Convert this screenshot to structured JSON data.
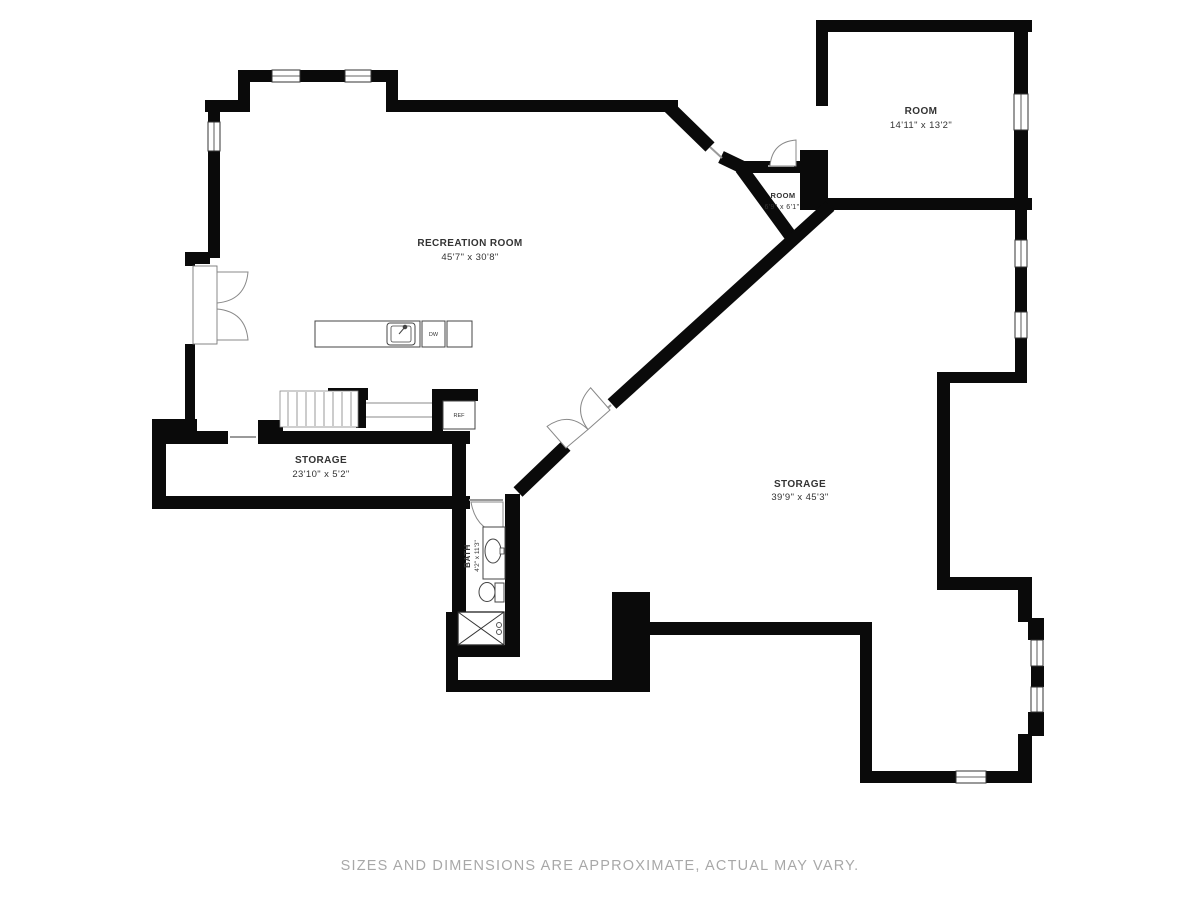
{
  "rooms": {
    "recreation_room": {
      "label": "RECREATION ROOM",
      "dimensions": "45'7\" x 30'8\""
    },
    "room_upper_right": {
      "label": "ROOM",
      "dimensions": "14'11\" x 13'2\""
    },
    "room_small": {
      "label": "ROOM",
      "dimensions": "6'9\" x 6'1\""
    },
    "storage_lower_left": {
      "label": "STORAGE",
      "dimensions": "23'10\" x 5'2\""
    },
    "storage_right": {
      "label": "STORAGE",
      "dimensions": "39'9\" x 45'3\""
    },
    "bath": {
      "label": "BATH",
      "dimensions": "4'2\" x 11'3\""
    }
  },
  "appliances": {
    "refrigerator_label": "REF",
    "dishwasher_label": "DW"
  },
  "footer": {
    "disclaimer": "SIZES AND DIMENSIONS ARE APPROXIMATE, ACTUAL MAY VARY."
  },
  "colors": {
    "walls": "#000000",
    "labels": "#333333",
    "fixtures": "#555555",
    "footer_text": "#a8a8a8",
    "background": "#ffffff"
  }
}
